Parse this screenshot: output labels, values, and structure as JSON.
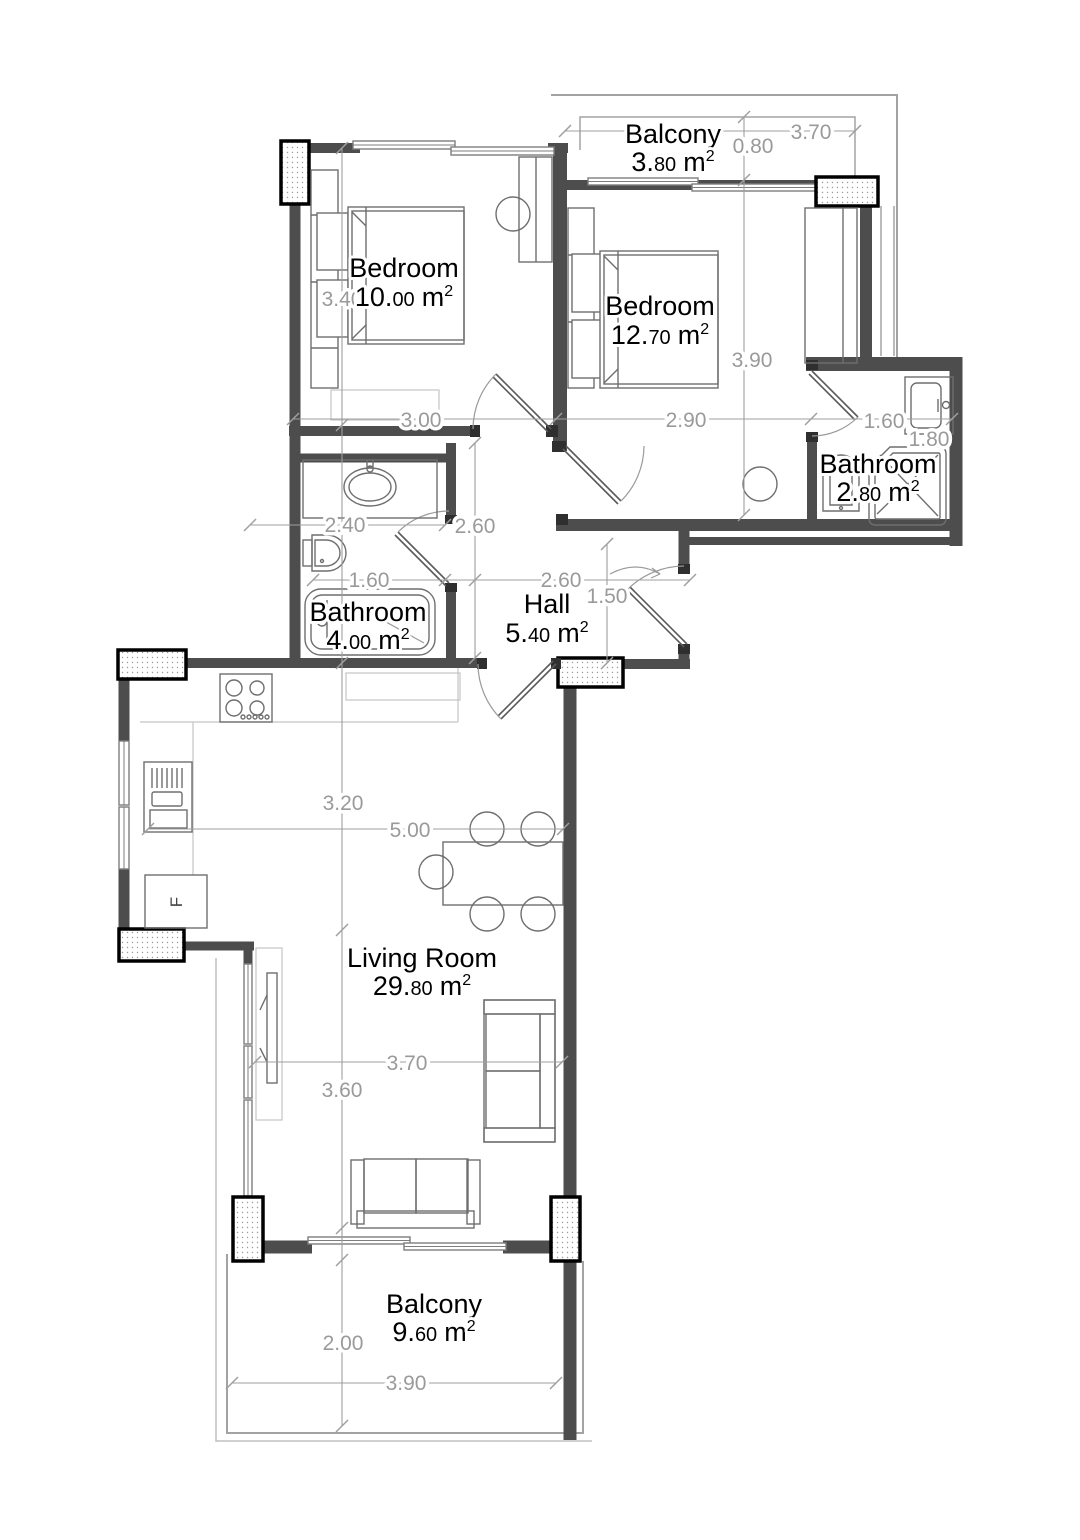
{
  "title": "Apartment floor plan",
  "rooms": {
    "balcony_top": {
      "name": "Balcony",
      "area": "3.80 m²",
      "area_main": "3.",
      "area_frac": "80",
      "unit": "m",
      "sup": "2"
    },
    "bedroom_1": {
      "name": "Bedroom",
      "area": "10.00 m²",
      "area_main": "10.",
      "area_frac": "00",
      "unit": "m",
      "sup": "2"
    },
    "bedroom_2": {
      "name": "Bedroom",
      "area": "12.70 m²",
      "area_main": "12.",
      "area_frac": "70",
      "unit": "m",
      "sup": "2"
    },
    "bathroom_right": {
      "name": "Bathroom",
      "area": "2.80 m²",
      "area_main": "2.",
      "area_frac": "80",
      "unit": "m",
      "sup": "2"
    },
    "bathroom_left": {
      "name": "Bathroom",
      "area": "4.00 m²",
      "area_main": "4.",
      "area_frac": "00",
      "unit": "m",
      "sup": "2"
    },
    "hall": {
      "name": "Hall",
      "area": "5.40 m²",
      "area_main": "5.",
      "area_frac": "40",
      "unit": "m",
      "sup": "2"
    },
    "living": {
      "name": "Living Room",
      "area": "29.80 m²",
      "area_main": "29.",
      "area_frac": "80",
      "unit": "m",
      "sup": "2"
    },
    "balcony_bottom": {
      "name": "Balcony",
      "area": "9.60 m²",
      "area_main": "9.",
      "area_frac": "60",
      "unit": "m",
      "sup": "2"
    }
  },
  "dims": {
    "balcony_top_width": "3.70",
    "balcony_top_depth": "0.80",
    "bedroom1_height": "3.40",
    "bedroom1_width": "3.00",
    "bedroom2_height": "3.90",
    "bedroom2_width": "2.90",
    "bathroom_right_width": "1.60",
    "bathroom_right_width_outer": "1.80",
    "bathroom_left_top_width": "2.40",
    "corridor_height": "2.60",
    "bathroom_left_width": "1.60",
    "hall_width": "2.60",
    "hall_entry_depth": "1.50",
    "kitchen_height": "3.20",
    "living_width": "5.00",
    "living_inner_width": "3.70",
    "living_height": "3.60",
    "balcony_bottom_depth": "2.00",
    "balcony_bottom_width": "3.90"
  },
  "labels": {
    "fridge": "F"
  },
  "colors": {
    "wall": "#4d4d4d",
    "dim_text": "#9a9a9a",
    "room_text": "#000000",
    "pillar_border": "#000000"
  }
}
